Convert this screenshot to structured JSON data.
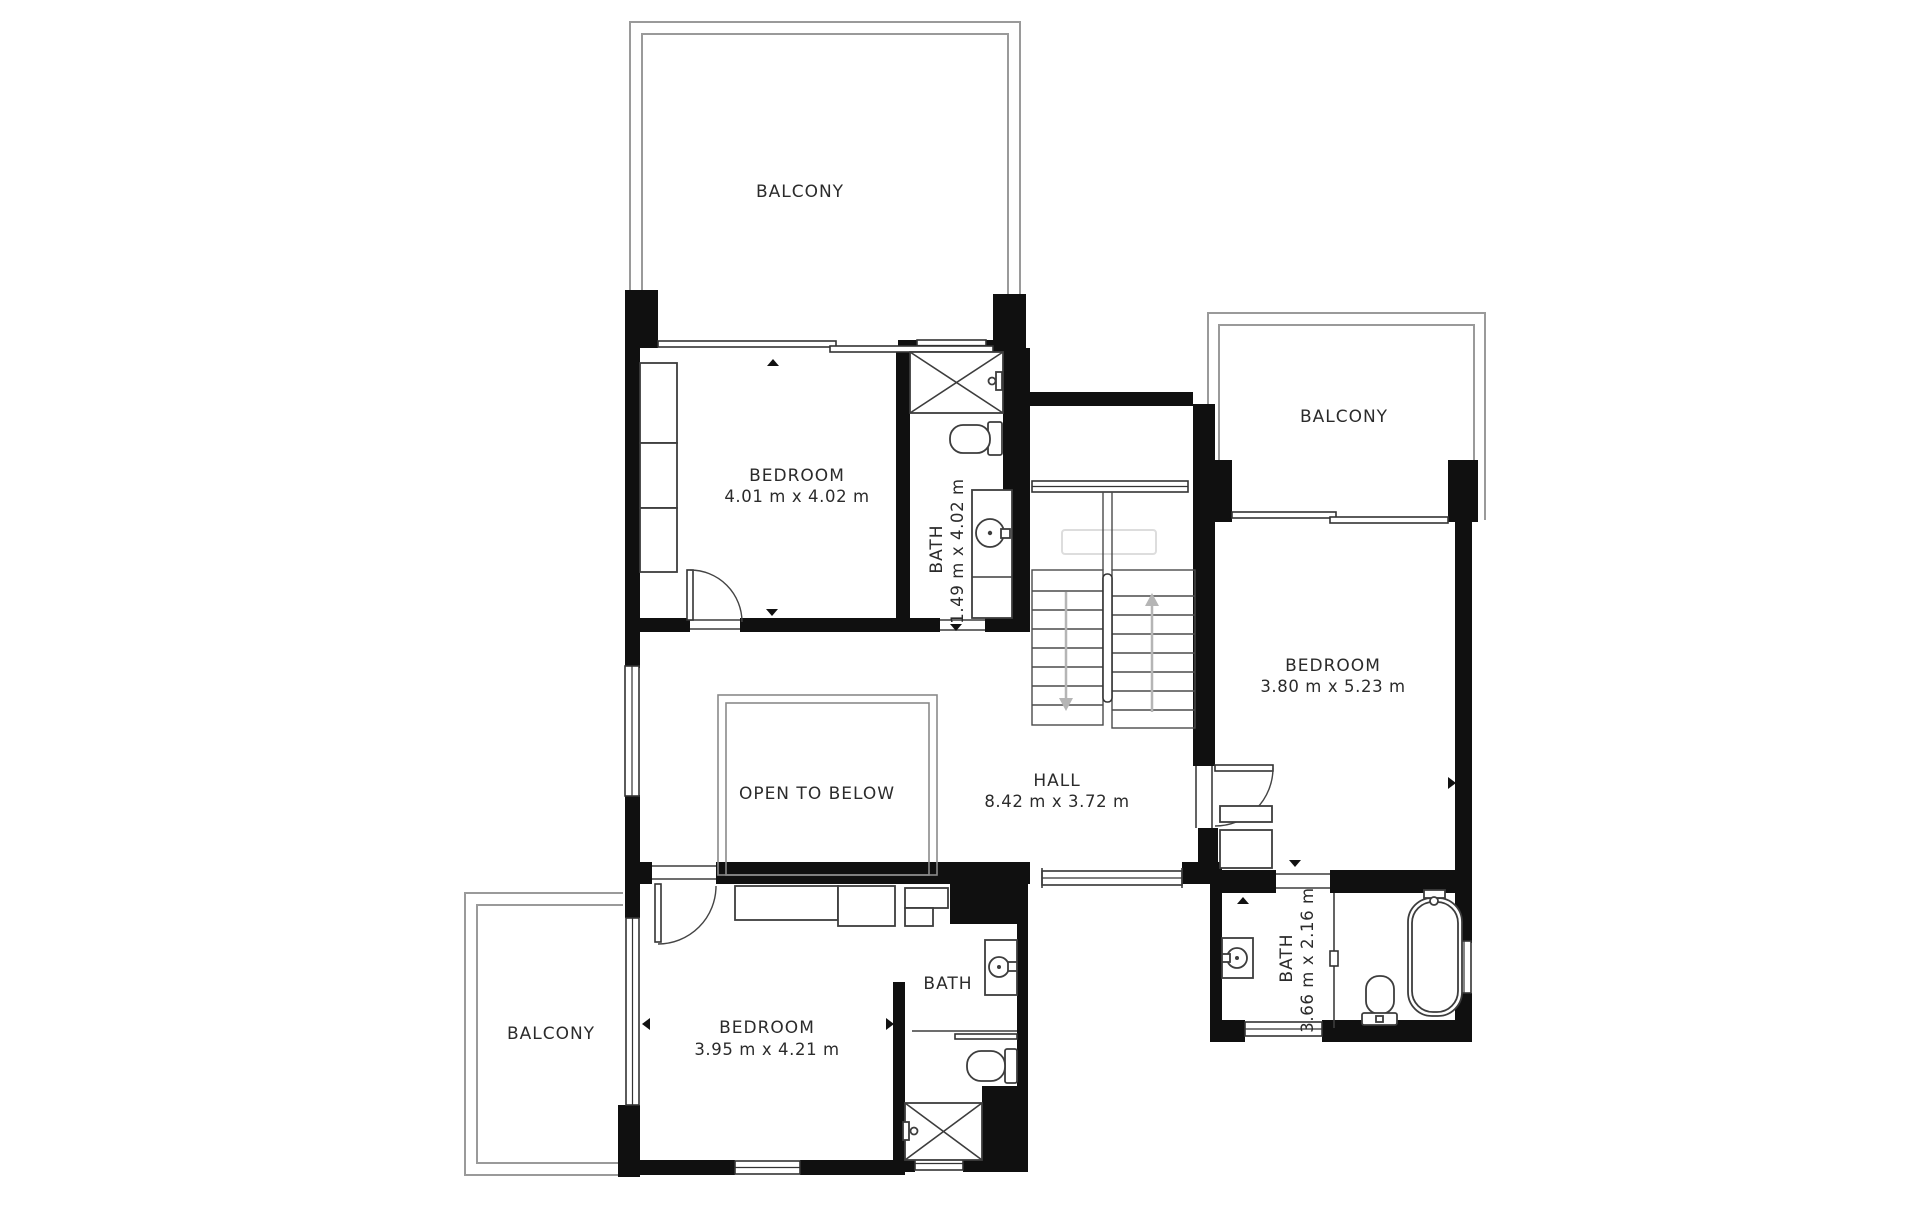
{
  "plan": {
    "type": "floor-plan",
    "colors": {
      "background": "#ffffff",
      "wall": "#101010",
      "thin_line": "#3d3d3d",
      "balcony_line": "#9a9a9a",
      "label": "#2b2b2b",
      "stairs_arrow": "#b5b5b5"
    }
  },
  "rooms": [
    {
      "id": "balcony-top",
      "label": "BALCONY"
    },
    {
      "id": "bedroom-upper",
      "label": "BEDROOM",
      "dims": "4.01 m x 4.02 m"
    },
    {
      "id": "bath-upper",
      "label": "BATH",
      "dims": "1.49 m x 4.02 m"
    },
    {
      "id": "balcony-right",
      "label": "BALCONY"
    },
    {
      "id": "bedroom-right",
      "label": "BEDROOM",
      "dims": "3.80 m x 5.23 m"
    },
    {
      "id": "hall",
      "label": "HALL",
      "dims": "8.42 m x 3.72 m"
    },
    {
      "id": "open-to-below",
      "label": "OPEN TO BELOW"
    },
    {
      "id": "bedroom-lower",
      "label": "BEDROOM",
      "dims": "3.95 m x 4.21 m"
    },
    {
      "id": "bath-lower",
      "label": "BATH"
    },
    {
      "id": "bath-right",
      "label": "BATH",
      "dims": "3.66 m x 2.16 m"
    },
    {
      "id": "balcony-lower",
      "label": "BALCONY"
    }
  ]
}
